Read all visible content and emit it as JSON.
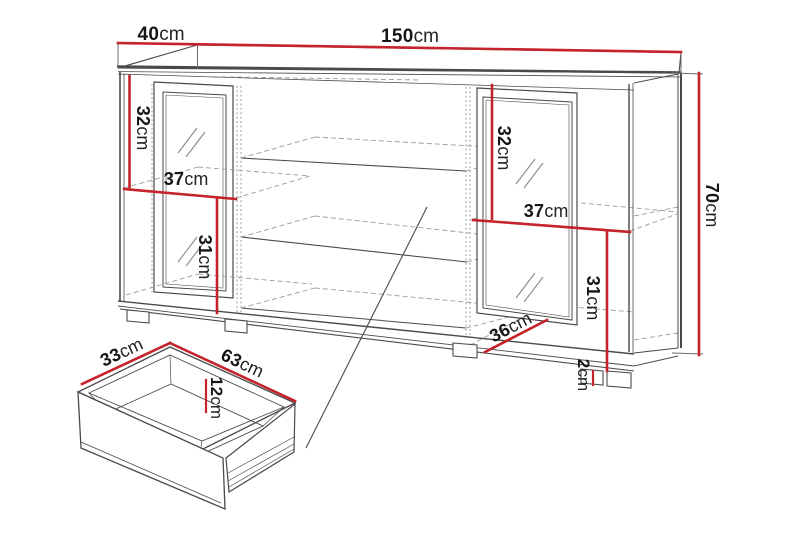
{
  "diagram": {
    "type": "furniture-dimension-drawing",
    "subject": "sideboard with two glass doors, open shelves and a drawer detail",
    "colors": {
      "dimension_line": "#c5232a",
      "outline": "#4a4a4a",
      "hidden_line": "#9b9b9b",
      "text": "#161616",
      "background": "#ffffff"
    }
  },
  "dims": {
    "depth_top": {
      "num": "40",
      "unit": "cm"
    },
    "width_top": {
      "num": "150",
      "unit": "cm"
    },
    "height_right": {
      "num": "70",
      "unit": "cm"
    },
    "left_upper": {
      "num": "32",
      "unit": "cm"
    },
    "left_shelf": {
      "num": "37",
      "unit": "cm"
    },
    "left_lower": {
      "num": "31",
      "unit": "cm"
    },
    "right_upper": {
      "num": "32",
      "unit": "cm"
    },
    "right_shelf": {
      "num": "37",
      "unit": "cm"
    },
    "right_lower": {
      "num": "31",
      "unit": "cm"
    },
    "interior_depth": {
      "num": "36",
      "unit": "cm"
    },
    "plinth_height": {
      "num": "2",
      "unit": "cm"
    },
    "drawer_depth": {
      "num": "33",
      "unit": "cm"
    },
    "drawer_width": {
      "num": "63",
      "unit": "cm"
    },
    "drawer_height": {
      "num": "12",
      "unit": "cm"
    }
  }
}
